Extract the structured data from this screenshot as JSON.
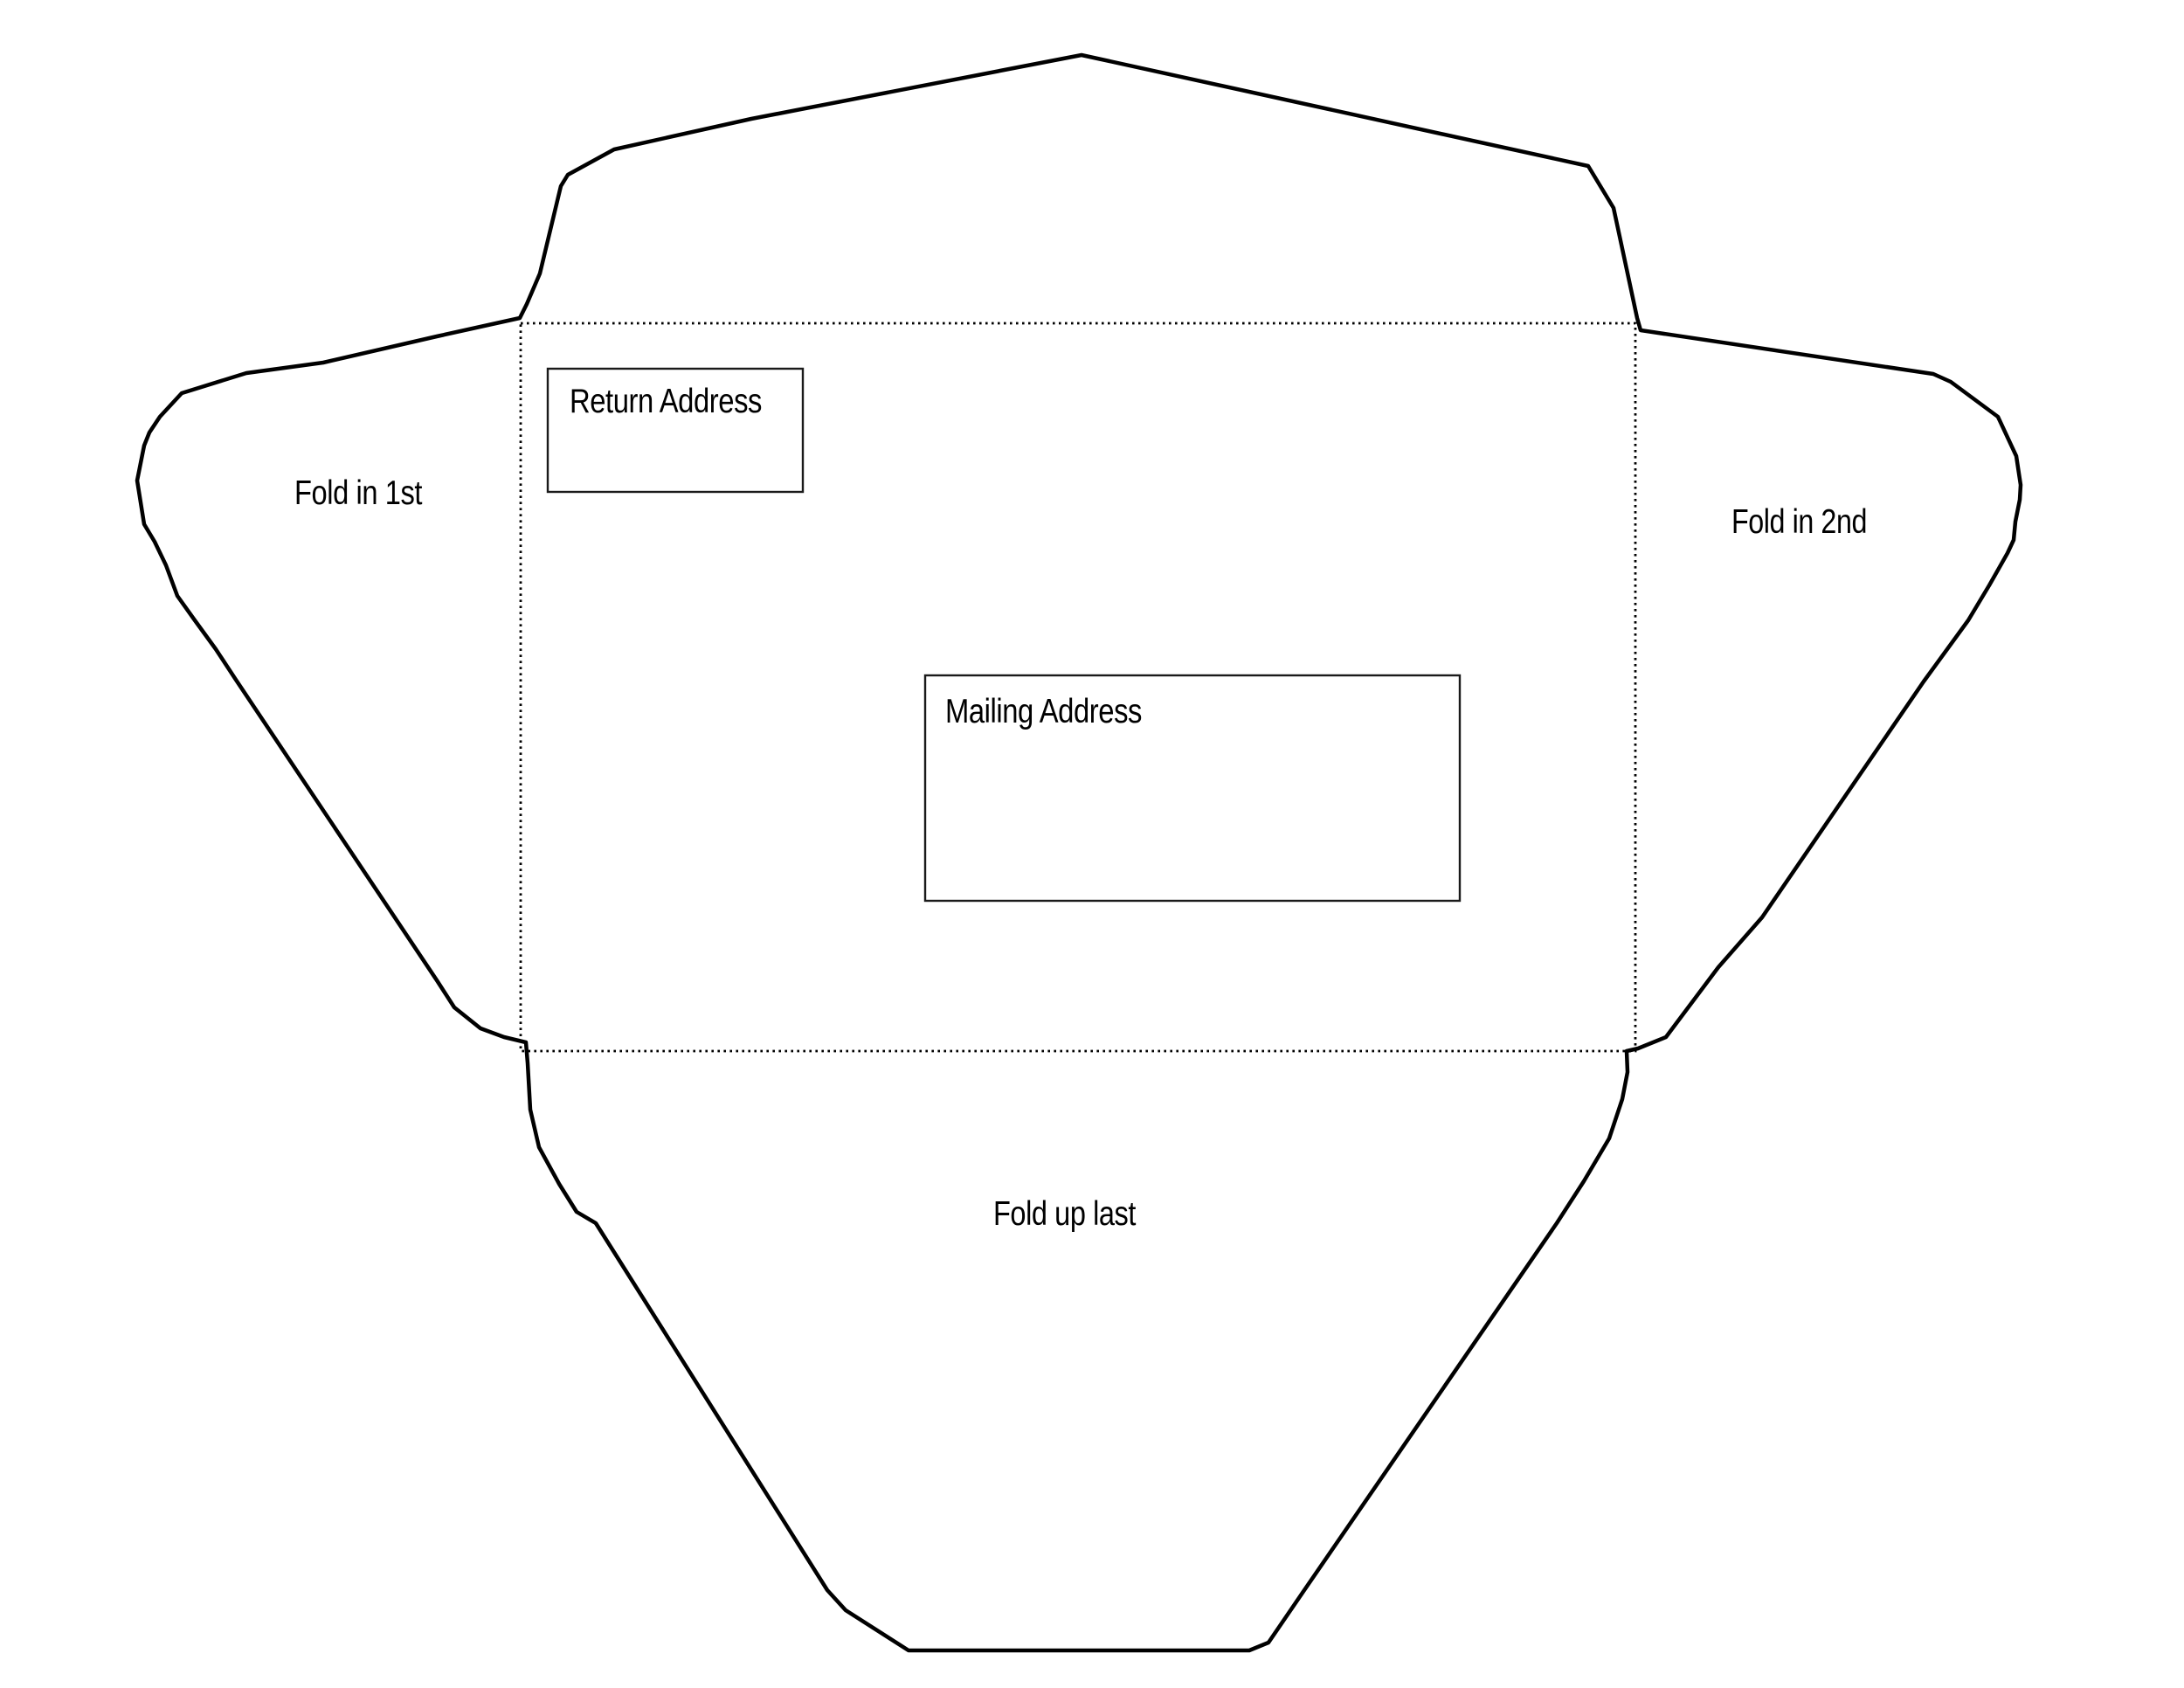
{
  "diagram": {
    "type": "envelope-fold-template",
    "colors": {
      "background": "#ffffff",
      "outline": "#000000"
    },
    "center_panel": {
      "return_address_label": "Return Address",
      "mailing_address_label": "Mailing Address"
    },
    "flaps": {
      "left_label": "Fold in 1st",
      "right_label": "Fold in 2nd",
      "bottom_label": "Fold up last"
    }
  }
}
